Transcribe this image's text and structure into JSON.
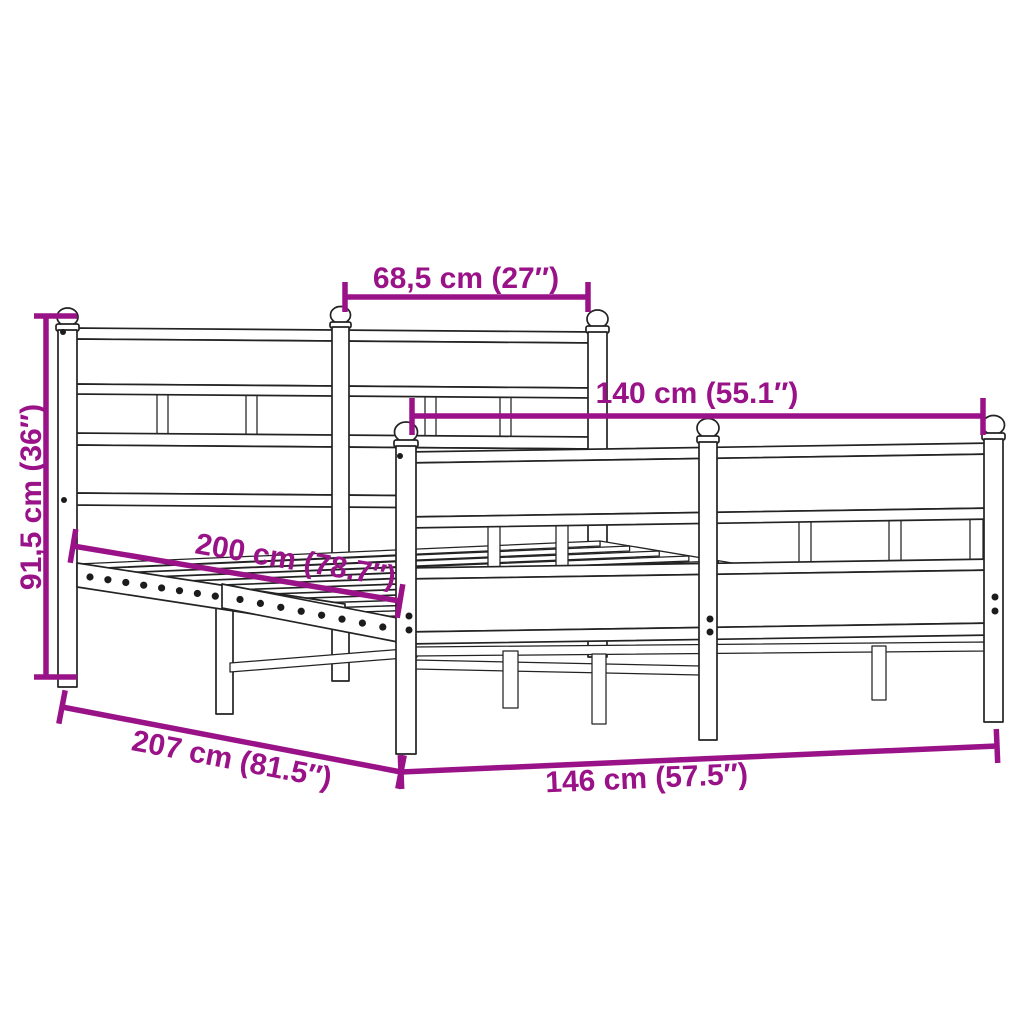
{
  "diagram": {
    "name": "Metal bed frame with headboard and footboard — dimension diagram",
    "background_color": "#ffffff",
    "line_color": "#232323",
    "dimension_color": "#9a1287",
    "dimensions": {
      "headboard_section_width": {
        "label": "68,5 cm (27″)",
        "cm": "68,5",
        "inches": "27"
      },
      "footboard_width": {
        "label": "140 cm (55.1″)",
        "cm": "140",
        "inches": "55.1"
      },
      "headboard_height": {
        "label": "91,5 cm (36″)",
        "cm": "91,5",
        "inches": "36"
      },
      "sleeping_surface_length": {
        "label": "200 cm (78.7″)",
        "cm": "200",
        "inches": "78.7"
      },
      "total_length": {
        "label": "207 cm (81.5″)",
        "cm": "207",
        "inches": "81.5"
      },
      "total_width": {
        "label": "146 cm (57.5″)",
        "cm": "146",
        "inches": "57.5"
      }
    }
  }
}
